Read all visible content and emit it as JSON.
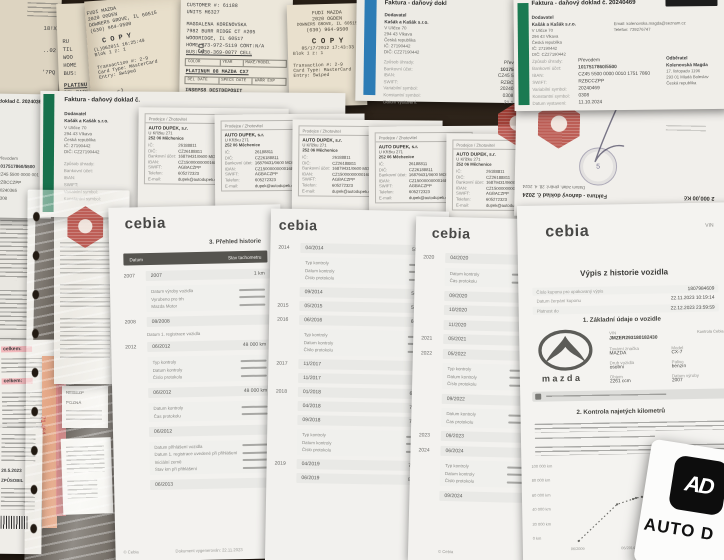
{
  "photo": {
    "surface_color": "#261d14"
  },
  "receipts": {
    "stub": {
      "fragments": [
        "18!X",
        "..02",
        "'7PQ"
      ]
    },
    "behind": {
      "lines": [
        "RU",
        "TIL",
        "WOO",
        "HOME",
        "BUS:"
      ],
      "lower": [
        "PLATINU",
        "DEL DATE",
        "INSEPS8 DL",
        "M.O OPEN"
      ],
      "mark": "03"
    },
    "copy": {
      "store": "FUDI MAZDA",
      "addr1": "2020 OGDEN",
      "addr2": "DOWNERS GROVE, IL 60515",
      "phone": "(630) 964-9500",
      "copy_label": "C O P Y",
      "datetime": "(L)062011 16:25:49",
      "slip": "Blok 1 z: 1",
      "tx": "Transaction #:  2-9",
      "card": "Card Type: MasterCard",
      "entry": "Entry:  Swiped",
      "code": "6770 CJ"
    },
    "fudi": {
      "store": "FUDI MAZDA",
      "addr1": "2020 OGDEN",
      "addr2": "DOWNERS GROVE, IL 60515",
      "phone": "(630) 964-9500",
      "copy_label": "C O P Y",
      "datetime": "05/17/2012 17:43:33",
      "slip": "Blok 1 z: 1",
      "tx": "Transaction #:  2-9",
      "card": "Card Type: MasterCard",
      "entry": "Entry:  Swiped"
    },
    "customer": {
      "customer_no": "CUSTOMER #: 61188",
      "units": "UNITS M6327",
      "name": "MAGDALENA KORENOVSKA",
      "addr1": "7982 BURR RIDGE CT #205",
      "addr2": "WOODRIDGE, IL 60517",
      "home": "HOME:773-972-5119 CONT:N/A",
      "bus": "BUS: 630-369-0077 CELL",
      "cols": [
        "COLOR",
        "YEAR",
        "MAKE/MODEL"
      ],
      "vehicle": "PLATINUM  08  MAZDA CX7",
      "cols2": [
        "DEL DATE",
        "SPECS DATE",
        "WARR EXP"
      ],
      "deposit": "INSEPS8 DESTDEPOSIT",
      "status": "M.O OPENED      READY"
    }
  },
  "faktura": {
    "labels": [
      "Způsob úhrady:",
      "Bankovní účet:",
      "IBAN:",
      "SWIFT:",
      "Variabilní symbol:",
      "Konstantní symbol:"
    ],
    "date_label": "Datum vystavení:",
    "supplier_label": "Dodavatel",
    "supplier": [
      "Kašák a Kašák s.r.o.",
      "V Uličce 70",
      "294 43 Vlkava",
      "Česká republika",
      "IČ: 27190442",
      "DIČ: CZ27190442"
    ],
    "a": {
      "title": "Faktura - daňový dokl",
      "values": [
        "Přev",
        "10175",
        "CZ45 5",
        "RZBC",
        "20240",
        "0308"
      ],
      "date": "21.1"
    },
    "b": {
      "title": "Faktura - daňový doklad č. 20240469",
      "email": "Email: kolenovska.magda@seznam.cz",
      "phone": "Telefon: 739276747",
      "customer_label": "Odběratel",
      "customer": [
        "Kolenovská Magda",
        "17. listopadu 1196",
        "293 01 Mladá Boleslav",
        "Česká republika"
      ],
      "values": [
        "Převodem",
        "1017517860/5500",
        "CZ45 5500 0000 0010 1751 7860",
        "RZBCCZPP",
        "20240469",
        "0308"
      ],
      "date": "11.10.2024"
    },
    "c": {
      "title": "doklad č. 20240365",
      "pay_label": "Převodem",
      "values": [
        "1017517860/5500",
        "CZ45 5500 0000 001",
        "RZBCCZPP",
        "20240365",
        "0308"
      ]
    },
    "d": {
      "title": "Faktura - daňový doklad č.",
      "values": [
        "Převodem",
        "1017517",
        "CZ45 550",
        "RZBCCZP",
        "20240208",
        "0308"
      ]
    }
  },
  "dupek": {
    "box_label": "Prodejce / Zhotovitel",
    "name": "AUTO DUPEK, s.r.",
    "addr1": "U Křížku 271",
    "addr2": "252 06  Měchenice",
    "rows": [
      {
        "l": "IČ:",
        "v": "26188811"
      },
      {
        "l": "DIČ:",
        "v": "CZ26188811"
      },
      {
        "l": "Bankovní účet:",
        "v": "16879431/0600 MONE"
      },
      {
        "l": "IBAN:",
        "v": "CZ15000000000168794"
      },
      {
        "l": "SWIFT:",
        "v": "AGBACZPP"
      },
      {
        "l": "Telefon:",
        "v": "605272323"
      },
      {
        "l": "E-mail:",
        "v": "dupek@autodupek.cz"
      }
    ]
  },
  "flipped": {
    "title": "Faktura - daňový doklad č. 2024",
    "tax_line": "Datum zdaň. plnění: 28. 4. 2024",
    "amount": "2 000,00 Kč",
    "stamp_number": "5"
  },
  "cebia_a": {
    "logo": "cebia",
    "section": "3. Přehled historie",
    "th_date": "Datum",
    "th_km": "Stav tachometru",
    "rows": [
      {
        "y": "2007",
        "d": "2007",
        "k": "1 km"
      },
      {
        "y": "2008",
        "d": "08/2008",
        "k": ""
      },
      {
        "y": "2012",
        "d": "06/2012",
        "k": "48 000 km"
      },
      {
        "y": "",
        "d": "06/2012",
        "k": "48 000 km"
      },
      {
        "y": "",
        "d": "06/2012",
        "k": ""
      },
      {
        "y": "",
        "d": "06/2013",
        "k": ""
      }
    ],
    "box1": [
      "Datum výroby vozidla",
      "Vyrobeno pro trh",
      "Mazda Motor"
    ],
    "box2": [
      "Typ kontroly",
      "Datum kontroly",
      "Číslo protokolu"
    ],
    "box3": [
      "Datum kontroly",
      "Čas protokolu"
    ],
    "box4": [
      "Datum přihlášení vozidla",
      "Datum 1. registrace uvedené při přihlášení",
      "Iniciální země",
      "Stav km při přihlášení"
    ],
    "reg_label": "Datum 1. registrace vozidla",
    "footer_copy": "© Cebia",
    "footer_gen": "Dokument vygenerován: 22.11.2023"
  },
  "cebia_b": {
    "logo": "cebia",
    "rows": [
      {
        "y": "2014",
        "d": "04/2014",
        "k": "55 000 km"
      },
      {
        "y": "",
        "d": "09/2014",
        "k": "56 000 km"
      },
      {
        "y": "2015",
        "d": "05/2015",
        "k": "58 000 km"
      },
      {
        "y": "2016",
        "d": "06/2016",
        "k": "60 000 km"
      },
      {
        "y": "2017",
        "d": "11/2017",
        "k": ""
      },
      {
        "y": "",
        "d": "11/2017",
        "k": ""
      },
      {
        "y": "2018",
        "d": "01/2018",
        "k": "68 000 km"
      },
      {
        "y": "",
        "d": "04/2018",
        "k": "72 000 km"
      },
      {
        "y": "",
        "d": "09/2018",
        "k": "72 000 km"
      },
      {
        "y": "2019",
        "d": "04/2019",
        "k": "72 500 km"
      },
      {
        "y": "",
        "d": "06/2019",
        "k": "84 000 km"
      }
    ],
    "box": [
      "Typ kontroly",
      "Datum kontroly",
      "Číslo protokolu"
    ]
  },
  "cebia_c": {
    "logo": "cebia",
    "rows": [
      {
        "y": "2020",
        "d": "04/2020"
      },
      {
        "y": "",
        "d": "09/2020"
      },
      {
        "y": "",
        "d": "10/2020"
      },
      {
        "y": "",
        "d": "11/2020"
      },
      {
        "y": "2021",
        "d": "05/2021"
      },
      {
        "y": "2022",
        "d": "05/2022"
      },
      {
        "y": "",
        "d": "09/2022"
      },
      {
        "y": "2023",
        "d": "09/2023"
      },
      {
        "y": "2024",
        "d": "06/2024"
      },
      {
        "y": "",
        "d": "09/2024"
      }
    ],
    "box_a": [
      "Datum kontroly",
      "Čas protokolu"
    ],
    "box_b": [
      "Typ kontroly",
      "Datum kontroly",
      "Číslo protokolu"
    ],
    "footer_copy": "© Cebia"
  },
  "vypis": {
    "logo": "cebia",
    "vin_corner": "VIN",
    "title": "Výpis z historie vozidla",
    "fields": [
      {
        "l": "Číslo kuponu pro opakovaný výpis",
        "v": "1807984609"
      },
      {
        "l": "Datum čerpání kuponu",
        "v": "22.11.2023 10:19:14"
      },
      {
        "l": "Platnost do",
        "v": "22.12.2023 23:59:59"
      }
    ],
    "section1": "1. Základní údaje o vozidle",
    "mazda_wordmark": "mazda",
    "vin_label": "VIN",
    "vin": "JMZER293180182430",
    "check_link": "Kontrola Cebia",
    "specs": [
      {
        "l": "Tovární značka",
        "v": "MAZDA"
      },
      {
        "l": "Model",
        "v": "CX-7"
      },
      {
        "l": "Druh vozidla",
        "v": "osobní"
      },
      {
        "l": "Palivo",
        "v": "benzín"
      },
      {
        "l": "Objem",
        "v": "2261 ccm"
      },
      {
        "l": "Datum výroby",
        "v": "2007"
      }
    ],
    "section2": "2. Kontrola najetých kilometrů",
    "chart_y": [
      "100 000 km",
      "80 000 km",
      "60 000 km",
      "40 000 km",
      "20 000 km",
      "0 km"
    ],
    "chart_x": [
      "06/2009",
      "06/2014",
      "06/2019",
      "06/2024"
    ]
  },
  "left_docs": {
    "total1": "celkem:",
    "total2": "celkem:",
    "mileage": "71 464",
    "date": "20.5.2023",
    "caused": "ZPŮSOBIL",
    "note1": "NEBEZP",
    "note2": "POZNÁ"
  },
  "watermark": {
    "logo_monogram": "AD",
    "brand_text": "AUTO D"
  },
  "chart_data": {
    "type": "line",
    "title": "2. Kontrola najetých kilometrů",
    "ylabel": "Stav tachometru (km)",
    "ylim": [
      0,
      100000
    ],
    "x": [
      "2007",
      "06/2012",
      "04/2014",
      "09/2014",
      "05/2015",
      "06/2016",
      "01/2018",
      "04/2020",
      "05/2021",
      "05/2022",
      "06/2024"
    ],
    "values": [
      0,
      48000,
      55000,
      56000,
      58000,
      60000,
      68000,
      72000,
      72000,
      72500,
      84000
    ],
    "style": "dotted",
    "legend": false
  }
}
